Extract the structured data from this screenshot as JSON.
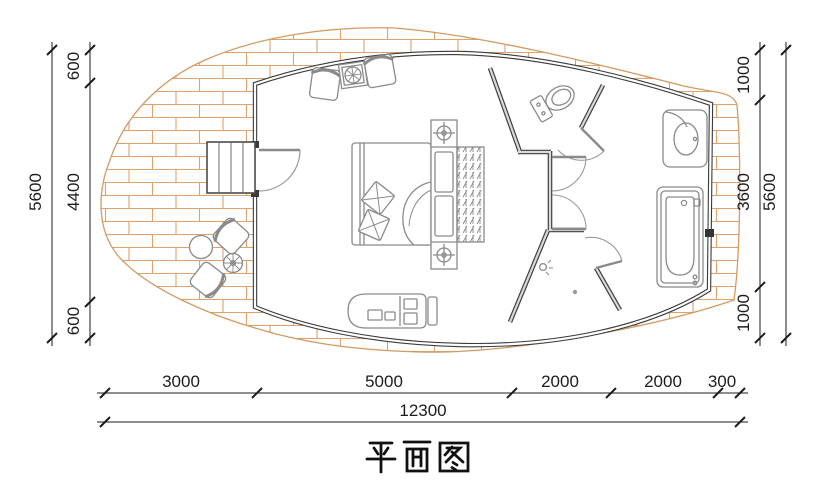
{
  "title": "平面图",
  "dimensions": {
    "left": {
      "segments": [
        "600",
        "4400",
        "600"
      ],
      "total": "5600"
    },
    "right": {
      "segments": [
        "1000",
        "3600",
        "1000"
      ],
      "total": "5600"
    },
    "bottom": {
      "segments": [
        "3000",
        "5000",
        "2000",
        "2000",
        "300"
      ],
      "total": "12300"
    }
  },
  "elements": [
    "deck-brick-paving",
    "entry-stairs",
    "entry-door",
    "double-bed",
    "pillows",
    "headboard-unit",
    "wardrobe",
    "armchair-left",
    "armchair-right",
    "side-table",
    "outdoor-round-table",
    "outdoor-parasol-table",
    "outdoor-chair-top",
    "outdoor-chair-bottom",
    "chaise-bench",
    "toilet-room",
    "toilet",
    "shower-room",
    "shower-head",
    "floor-drain",
    "vanity-sink",
    "bathtub",
    "corridor-doors"
  ],
  "colors": {
    "wall": "#3a3a3a",
    "partition_gap": "#d9d9d9",
    "furniture_line": "#8a8a8a",
    "deck_brick": "#dda26c",
    "dimension_line": "#1c1c1c"
  }
}
